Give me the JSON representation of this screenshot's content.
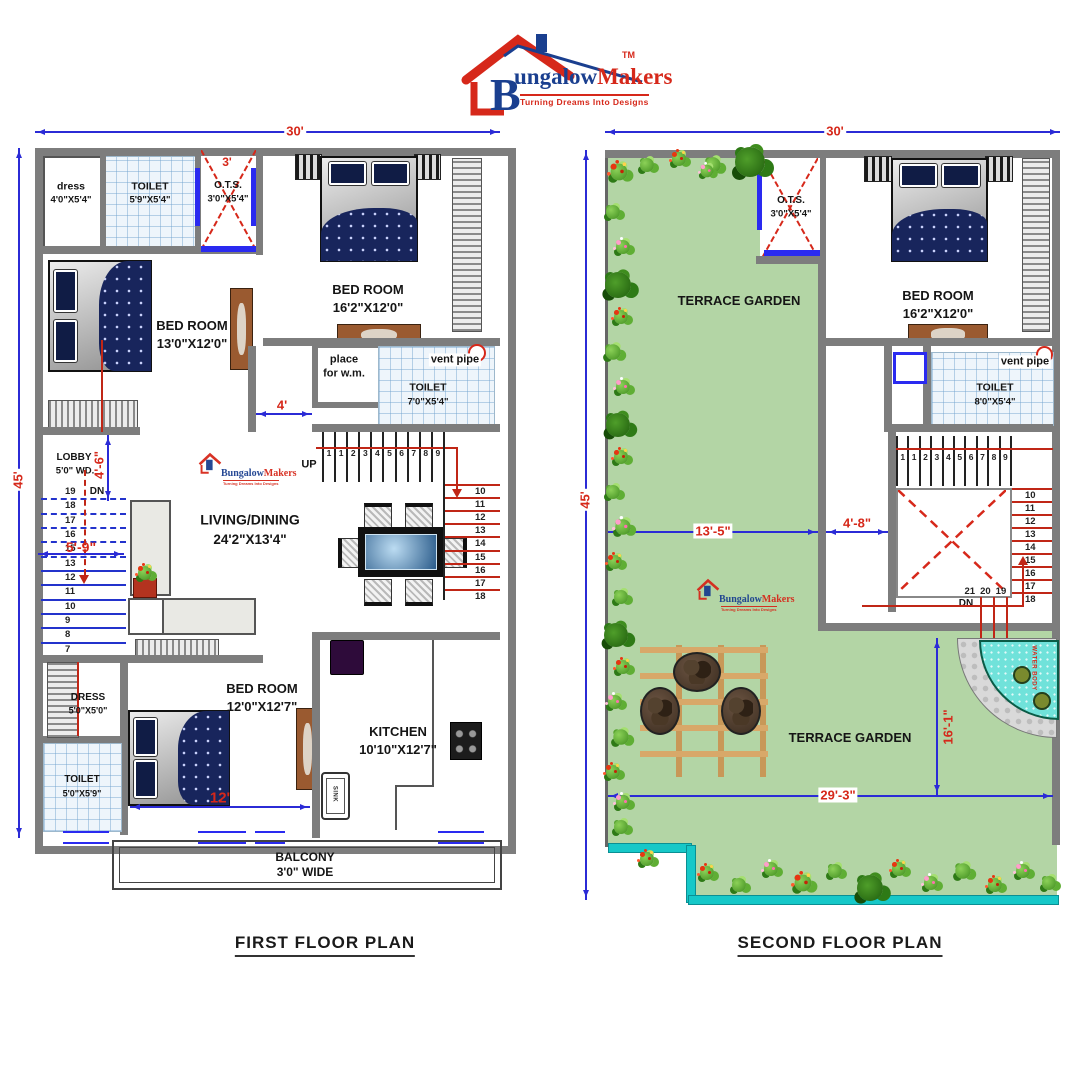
{
  "logo": {
    "tm": "TM",
    "brand_b": "B",
    "brand_blue": "ungalow",
    "brand_red": "Makers",
    "tagline": "Turning Dreams Into Designs"
  },
  "first_floor": {
    "title": "FIRST  FLOOR PLAN",
    "dim_top": "30'",
    "dim_left": "45'",
    "labels": {
      "dress_top_name": "dress",
      "dress_top_size": "4'0\"X5'4\"",
      "toilet_top_name": "TOILET",
      "toilet_top_size": "5'9\"X5'4\"",
      "ots_name": "O.T.S.",
      "ots_size": "3'0\"X5'4\"",
      "ots_dim": "3'",
      "bedroom_tr_name": "BED ROOM",
      "bedroom_tr_size": "16'2\"X12'0\"",
      "bedroom_left_name": "BED ROOM",
      "bedroom_left_size": "13'0\"X12'0\"",
      "place_wm_line1": "place",
      "place_wm_line2": "for w.m.",
      "toilet_mid_name": "TOILET",
      "toilet_mid_size": "7'0\"X5'4\"",
      "vent_pipe": "vent pipe",
      "lobby_name": "LOBBY",
      "lobby_size": "5'0\" WD.",
      "dim_lobby": "4'-6\"",
      "dim_passage": "4'",
      "dim_stair": "5'-9\"",
      "up": "UP",
      "dn": "DN",
      "living_name": "LIVING/DINING",
      "living_size": "24'2\"X13'4\"",
      "dress_b_name": "DRESS",
      "dress_b_size": "5'0\"X5'0\"",
      "toilet_b_name": "TOILET",
      "toilet_b_size": "5'0\"X5'9\"",
      "bedroom_b_name": "BED ROOM",
      "bedroom_b_size": "12'0\"X12'7\"",
      "dim_bed": "12'",
      "kitchen_name": "KITCHEN",
      "kitchen_size": "10'10\"X12'7\"",
      "sink": "SINK",
      "balcony_name": "BALCONY",
      "balcony_size": "3'0\" WIDE"
    },
    "stairs_top": [
      "1",
      "1",
      "2",
      "3",
      "4",
      "5",
      "6",
      "7",
      "8",
      "9"
    ],
    "stairs_right": [
      "10",
      "11",
      "12",
      "13",
      "14",
      "15",
      "16",
      "17",
      "18"
    ],
    "stairs_left": [
      "19",
      "18",
      "17",
      "16",
      "15",
      "13",
      "12",
      "11",
      "10",
      "9",
      "8",
      "7"
    ]
  },
  "second_floor": {
    "title": "SECOND  FLOOR PLAN",
    "dim_top": "30'",
    "dim_left": "45'",
    "labels": {
      "terrace_top": "TERRACE GARDEN",
      "terrace_bottom": "TERRACE GARDEN",
      "ots_name": "O.T.S.",
      "ots_size": "3'0\"X5'4\"",
      "bedroom_name": "BED ROOM",
      "bedroom_size": "16'2\"X12'0\"",
      "toilet_name": "TOILET",
      "toilet_size": "8'0\"X5'4\"",
      "vent_pipe": "vent pipe",
      "dim_terrace_w": "13'-5\"",
      "dim_stair_w": "4'-8\"",
      "dim_terrace_h": "16'-1\"",
      "dim_terrace_b": "29'-3\"",
      "dn": "DN",
      "water_body": "WATER BODY"
    },
    "stairs_top": [
      "1",
      "1",
      "2",
      "3",
      "4",
      "5",
      "6",
      "7",
      "8",
      "9"
    ],
    "stairs_right": [
      "10",
      "11",
      "12",
      "13",
      "14",
      "15",
      "16",
      "17",
      "18"
    ],
    "stairs_bottom": [
      "21",
      "20",
      "19"
    ]
  },
  "colors": {
    "dim_blue": "#2b2bd6",
    "dim_red": "#d6281a",
    "wall_gray": "#7d7d7d",
    "garden_green": "#b3d5a5",
    "water_cyan": "#70e2da",
    "window_blue": "#2a2af0"
  }
}
